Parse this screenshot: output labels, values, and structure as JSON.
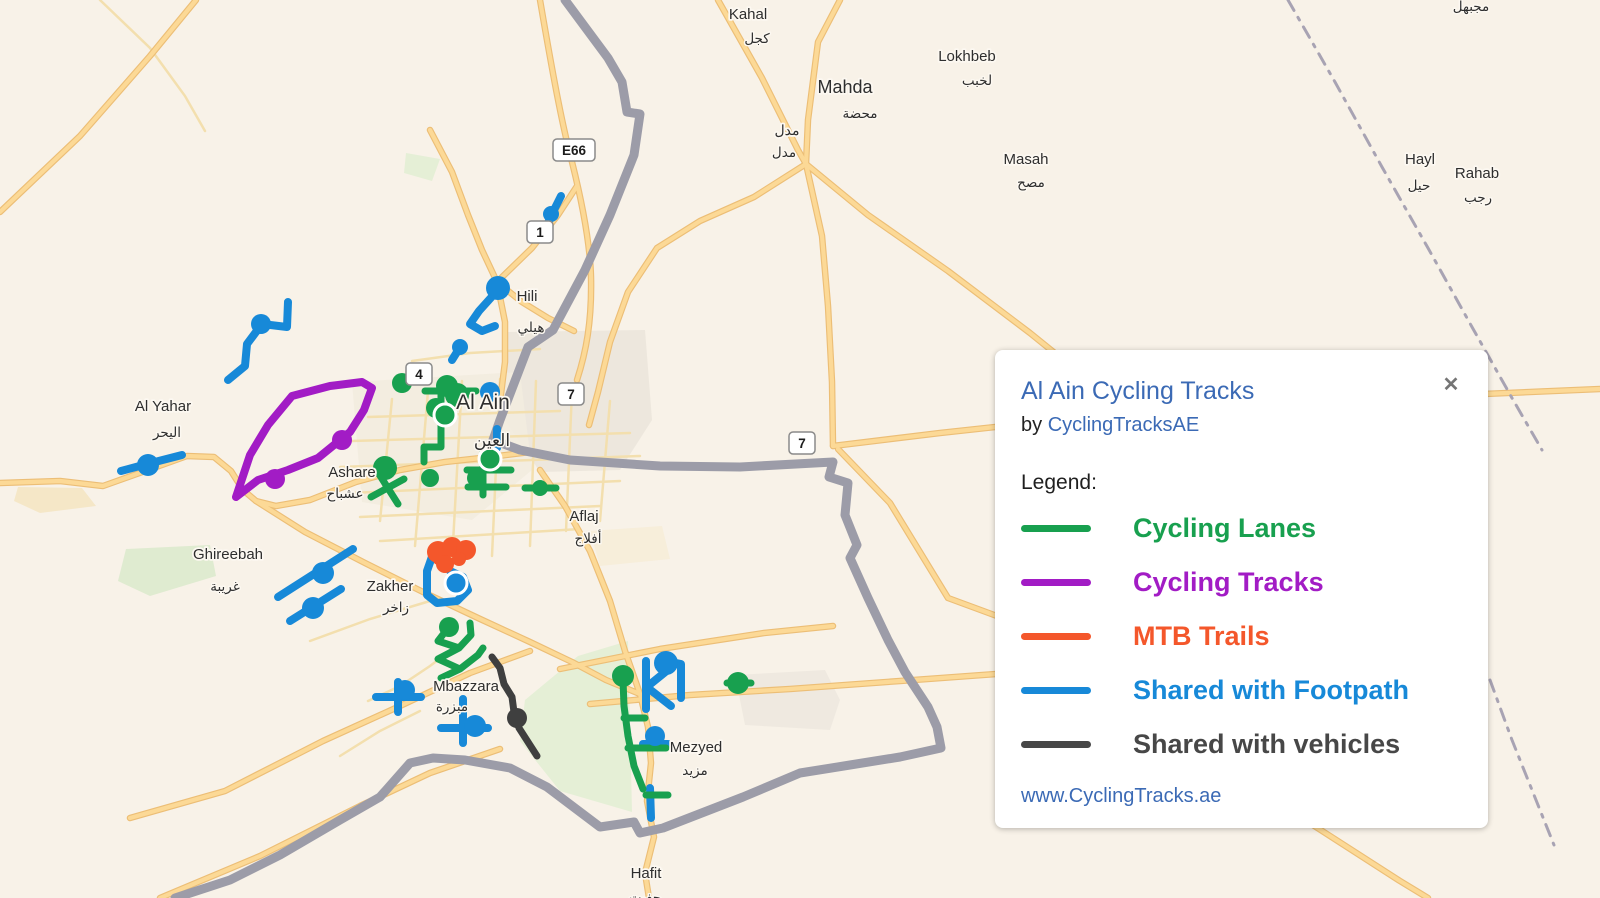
{
  "map": {
    "background": "#f8f2e8",
    "route_styles": {
      "lane": {
        "color": "#18a04f",
        "width": 7
      },
      "track": {
        "color": "#a21cc5",
        "width": 8
      },
      "mtb": {
        "color": "#f4572b",
        "width": 7
      },
      "foot": {
        "color": "#1789d8",
        "width": 8
      },
      "veh": {
        "color": "#3f3f3f",
        "width": 7
      }
    },
    "boundary_color": "#9c9ca8",
    "admin_color": "#a8a3b3",
    "patches": [
      {
        "fill": "#ebe5db",
        "d": "M505,332 L645,330 652,420 620,470 540,472 505,420 Z"
      },
      {
        "fill": "#f2ecdf",
        "d": "M352,382 L520,372 532,470 472,520 362,502 Z"
      },
      {
        "fill": "#dceacd",
        "d": "M126,549 L210,545 216,576 150,596 118,581 Z"
      },
      {
        "fill": "#e2eed4",
        "d": "M525,700 L578,656 628,641 632,812 560,791 520,741 Z"
      },
      {
        "fill": "#ede8df",
        "d": "M735,675 L825,670 840,700 830,730 745,725 Z"
      },
      {
        "fill": "#f4e6c3",
        "d": "M18,487 L82,488 96,506 40,513 14,501 Z"
      },
      {
        "fill": "#e2eed4",
        "d": "M406,153 L440,159 432,181 404,173 Z"
      },
      {
        "fill": "#f6edd8",
        "d": "M590,531 L662,526 670,559 600,566 Z"
      }
    ],
    "roads_major": [
      {
        "d": "M540,0 C552,70 562,125 572,162 C582,202 590,242 591,277 C592,322 586,352 577,380"
      },
      {
        "d": "M718,0 L762,78 798,150 806,164"
      },
      {
        "d": "M840,0 L818,42 808,120 806,164"
      },
      {
        "d": "M806,164 L754,197 700,221 657,248 628,292 610,342 598,392 589,425"
      },
      {
        "d": "M806,164 L822,236 828,306 832,382 833,446"
      },
      {
        "d": "M806,164 L868,215 948,271 1030,333 1098,388"
      },
      {
        "d": "M0,483 L60,481 103,486 148,470 187,456 214,457 231,471 243,490 256,501 276,506 310,500 356,482 400,470 445,462 490,457 530,452"
      },
      {
        "d": "M256,501 L305,532 365,563 425,593 478,618 530,642 572,662 606,680 640,694"
      },
      {
        "d": "M640,694 L648,727 651,763 647,801 654,837 645,873 649,898"
      },
      {
        "d": "M833,446 L940,433 1050,421 1160,411 1300,403 1460,395 1600,389"
      },
      {
        "d": "M838,449 L890,503 948,598 1005,619 1065,641"
      },
      {
        "d": "M1005,619 L1120,701 1260,791 1400,881 1428,898"
      },
      {
        "d": "M590,704 L690,695 790,689 900,681 1010,673 1065,669"
      },
      {
        "d": "M560,669 L660,649 764,633 833,626"
      },
      {
        "d": "M430,130 L452,172 468,215 482,250 497,282 505,322 505,362 500,402"
      },
      {
        "d": "M497,282 L532,248 558,215 577,186"
      },
      {
        "d": "M130,818 L225,791 323,741 400,706 470,673 530,651"
      },
      {
        "d": "M160,898 L260,856 360,806 430,773 500,749"
      },
      {
        "d": "M0,212 L80,136 150,56 196,0"
      },
      {
        "d": "M540,470 L565,506 590,551 610,601 625,651 640,694"
      },
      {
        "d": "M497,282 L522,302 548,318 574,331"
      }
    ],
    "roads_minor": [
      {
        "d": "M368,417 L560,411"
      },
      {
        "d": "M352,441 L630,433"
      },
      {
        "d": "M340,467 L640,456"
      },
      {
        "d": "M350,493 L620,481"
      },
      {
        "d": "M360,517 L600,506"
      },
      {
        "d": "M380,541 L580,529"
      },
      {
        "d": "M392,399 L380,521"
      },
      {
        "d": "M428,391 L415,546"
      },
      {
        "d": "M462,381 L452,561"
      },
      {
        "d": "M500,379 L492,556"
      },
      {
        "d": "M536,381 L530,546"
      },
      {
        "d": "M572,391 L566,531"
      },
      {
        "d": "M610,401 L600,521"
      },
      {
        "d": "M412,361 L470,353 540,349"
      },
      {
        "d": "M310,641 L370,619 430,601"
      },
      {
        "d": "M420,711 L380,731 340,756"
      },
      {
        "d": "M463,641 L430,666 400,686 368,701"
      },
      {
        "d": "M100,0 L150,48 185,96 205,131"
      }
    ],
    "boundary": "M565,0 L608,58 622,82 627,112 640,114 634,155 610,215 585,270 553,330 528,347 500,420 493,440 520,450 570,460 660,466 740,467 833,462 829,477 848,483 845,515 857,545 850,558 868,598 888,640 905,672 928,707 937,727 941,748 900,757 850,765 800,773 743,797 663,828 640,833 634,822 600,827 547,787 510,768 465,760 433,758 410,763 380,797 340,820 280,855 230,880 175,898",
    "admin_dashes": [
      "M1288,0 L1335,82 1382,167 1428,248 1472,327 1512,398 1542,450",
      "M1490,680 L1512,740 1536,800 1554,845"
    ],
    "routes": [
      {
        "kind": "track",
        "d": "M236,497 L250,455 268,425 292,396 330,386 362,382 372,388 364,410 350,432 318,458 288,470 258,480 236,497"
      },
      {
        "kind": "foot",
        "d": "M288,302 L287,327 262,324 247,344 245,366 228,380"
      },
      {
        "kind": "foot",
        "d": "M561,196 L552,214 544,232"
      },
      {
        "kind": "foot",
        "d": "M497,291 L479,311 470,324 482,331 495,326"
      },
      {
        "kind": "foot",
        "d": "M462,344 L452,360"
      },
      {
        "kind": "foot",
        "d": "M121,471 L147,464 182,455"
      },
      {
        "kind": "foot",
        "d": "M278,597 L353,549"
      },
      {
        "kind": "foot",
        "d": "M290,621 L341,589"
      },
      {
        "kind": "foot",
        "d": "M434,551 L427,571 427,595 437,603 457,601 468,590 463,577 450,571"
      },
      {
        "kind": "foot",
        "d": "M376,697 L421,697 M398,682 L398,712"
      },
      {
        "kind": "foot",
        "d": "M463,699 L463,743 M441,728 L488,728"
      },
      {
        "kind": "foot",
        "d": "M646,661 L646,709 M648,686 L669,669 M648,688 L671,706 M666,661 L681,664 681,698"
      },
      {
        "kind": "foot",
        "d": "M643,744 L668,744"
      },
      {
        "kind": "foot",
        "d": "M650,788 L651,818"
      },
      {
        "kind": "foot",
        "d": "M497,429 L497,448"
      },
      {
        "kind": "veh",
        "d": "M492,657 L500,668 504,684 512,697 514,712 519,728 528,742 537,756"
      },
      {
        "kind": "lane",
        "d": "M425,391 L476,391"
      },
      {
        "kind": "lane",
        "d": "M441,391 L441,447 424,447 424,462"
      },
      {
        "kind": "lane",
        "d": "M467,470 L511,470 M483,450 L483,495 M468,487 L506,487"
      },
      {
        "kind": "lane",
        "d": "M525,488 L556,488"
      },
      {
        "kind": "lane",
        "d": "M371,497 L404,479 M379,474 L398,504"
      },
      {
        "kind": "lane",
        "d": "M407,380 L423,367"
      },
      {
        "kind": "lane",
        "d": "M448,628 L438,641 459,648 438,659 460,669 441,678 M459,648 L471,635 470,623 M460,669 L478,655 483,648"
      },
      {
        "kind": "lane",
        "d": "M623,680 L624,706 628,736 634,766 643,789 M624,718 L645,718 M628,748 L666,748 M646,795 L668,795"
      },
      {
        "kind": "lane",
        "d": "M727,683 L751,683"
      },
      {
        "kind": "mtb",
        "d": "M432,556 L445,548 458,546 468,551 M437,561 L448,563 459,559"
      }
    ],
    "markers": [
      {
        "c": "lane",
        "x": 402,
        "y": 383,
        "r": 10
      },
      {
        "c": "lane",
        "x": 447,
        "y": 386,
        "r": 11
      },
      {
        "c": "lane",
        "x": 457,
        "y": 395,
        "r": 12
      },
      {
        "c": "lane",
        "x": 436,
        "y": 408,
        "r": 10
      },
      {
        "c": "lane",
        "x": 445,
        "y": 415,
        "r": 11,
        "ring": true
      },
      {
        "c": "lane",
        "x": 490,
        "y": 459,
        "r": 11,
        "ring": true
      },
      {
        "c": "lane",
        "x": 430,
        "y": 478,
        "r": 9
      },
      {
        "c": "lane",
        "x": 476,
        "y": 478,
        "r": 9
      },
      {
        "c": "lane",
        "x": 385,
        "y": 468,
        "r": 12
      },
      {
        "c": "lane",
        "x": 540,
        "y": 488,
        "r": 8
      },
      {
        "c": "lane",
        "x": 449,
        "y": 627,
        "r": 10
      },
      {
        "c": "lane",
        "x": 623,
        "y": 676,
        "r": 11
      },
      {
        "c": "lane",
        "x": 738,
        "y": 683,
        "r": 11
      },
      {
        "c": "foot",
        "x": 261,
        "y": 324,
        "r": 10
      },
      {
        "c": "foot",
        "x": 148,
        "y": 465,
        "r": 11
      },
      {
        "c": "foot",
        "x": 498,
        "y": 288,
        "r": 12
      },
      {
        "c": "foot",
        "x": 460,
        "y": 347,
        "r": 8
      },
      {
        "c": "foot",
        "x": 551,
        "y": 214,
        "r": 8
      },
      {
        "c": "foot",
        "x": 543,
        "y": 231,
        "r": 8
      },
      {
        "c": "foot",
        "x": 490,
        "y": 392,
        "r": 10
      },
      {
        "c": "foot",
        "x": 323,
        "y": 573,
        "r": 11
      },
      {
        "c": "foot",
        "x": 313,
        "y": 608,
        "r": 11
      },
      {
        "c": "foot",
        "x": 456,
        "y": 583,
        "r": 11,
        "ring": true
      },
      {
        "c": "foot",
        "x": 405,
        "y": 690,
        "r": 10
      },
      {
        "c": "foot",
        "x": 475,
        "y": 726,
        "r": 11
      },
      {
        "c": "foot",
        "x": 666,
        "y": 663,
        "r": 12
      },
      {
        "c": "foot",
        "x": 655,
        "y": 736,
        "r": 10
      },
      {
        "c": "mtb",
        "x": 438,
        "y": 552,
        "r": 11
      },
      {
        "c": "mtb",
        "x": 452,
        "y": 547,
        "r": 10
      },
      {
        "c": "mtb",
        "x": 466,
        "y": 550,
        "r": 10
      },
      {
        "c": "mtb",
        "x": 445,
        "y": 564,
        "r": 9
      },
      {
        "c": "mtb",
        "x": 459,
        "y": 559,
        "r": 7
      },
      {
        "c": "veh",
        "x": 517,
        "y": 718,
        "r": 10
      },
      {
        "c": "track",
        "x": 342,
        "y": 440,
        "r": 10
      },
      {
        "c": "track",
        "x": 275,
        "y": 479,
        "r": 10
      }
    ],
    "places": [
      {
        "en": "Kahal",
        "ar": "كجل",
        "x": 748,
        "y": 14,
        "ax": 757,
        "ay": 38
      },
      {
        "en": "Mahda",
        "ar": "محضة",
        "x": 845,
        "y": 88,
        "ax": 860,
        "ay": 113,
        "size": 18
      },
      {
        "en": "مدل",
        "ar": "مدل",
        "x": 787,
        "y": 130,
        "ax": 784,
        "ay": 152,
        "size": 14
      },
      {
        "en": "Lokhbeb",
        "ar": "لخبب",
        "x": 967,
        "y": 56,
        "ax": 977,
        "ay": 80
      },
      {
        "en": "Masah",
        "ar": "مصح",
        "x": 1026,
        "y": 159,
        "ax": 1031,
        "ay": 182
      },
      {
        "en": "Hayl",
        "ar": "حيل",
        "x": 1420,
        "y": 159,
        "ax": 1419,
        "ay": 185
      },
      {
        "en": "Rahab",
        "ar": "رجب",
        "x": 1477,
        "y": 173,
        "ax": 1478,
        "ay": 197
      },
      {
        "en": "",
        "ar": "مجبهل",
        "x": 1471,
        "y": 0,
        "ax": 1471,
        "ay": 6,
        "size": 14
      },
      {
        "en": "Hili",
        "ar": "هيلي",
        "x": 527,
        "y": 296,
        "ax": 531,
        "ay": 327
      },
      {
        "en": "Al Ain",
        "ar": "العين",
        "x": 483,
        "y": 404,
        "ax": 492,
        "ay": 441,
        "size": 21,
        "arsize": 17
      },
      {
        "en": "Al Yahar",
        "ar": "اليحر",
        "x": 163,
        "y": 406,
        "ax": 167,
        "ay": 432
      },
      {
        "en": "Ashare",
        "ar": "عشباح",
        "x": 352,
        "y": 472,
        "ax": 345,
        "ay": 493
      },
      {
        "en": "Ghireebah",
        "ar": "غريبة",
        "x": 228,
        "y": 554,
        "ax": 225,
        "ay": 586
      },
      {
        "en": "Zakher",
        "ar": "زاخر",
        "x": 390,
        "y": 586,
        "ax": 396,
        "ay": 607
      },
      {
        "en": "Aflaj",
        "ar": "أفلاج",
        "x": 584,
        "y": 516,
        "ax": 588,
        "ay": 538
      },
      {
        "en": "Mbazzara",
        "ar": "مبزرة",
        "x": 466,
        "y": 686,
        "ax": 452,
        "ay": 706
      },
      {
        "en": "Mezyed",
        "ar": "مزيد",
        "x": 696,
        "y": 747,
        "ax": 695,
        "ay": 770
      },
      {
        "en": "Hafit",
        "ar": "حفيت",
        "x": 646,
        "y": 873,
        "ax": 645,
        "ay": 897
      }
    ],
    "shields": [
      {
        "t": "E66",
        "x": 574,
        "y": 150,
        "w": 42
      },
      {
        "t": "1",
        "x": 540,
        "y": 232,
        "w": 26
      },
      {
        "t": "4",
        "x": 419,
        "y": 374,
        "w": 26
      },
      {
        "t": "7",
        "x": 571,
        "y": 394,
        "w": 26
      },
      {
        "t": "7",
        "x": 802,
        "y": 443,
        "w": 26
      }
    ]
  },
  "legend_card": {
    "title": "Al Ain Cycling Tracks",
    "byline_prefix": "by",
    "author": "CyclingTracksAE",
    "legend_label": "Legend:",
    "items": [
      {
        "label": "Cycling Lanes",
        "color": "#18a04f"
      },
      {
        "label": "Cycling Tracks",
        "color": "#a21cc5"
      },
      {
        "label": "MTB Trails",
        "color": "#f4572b"
      },
      {
        "label": "Shared with Footpath",
        "color": "#1789d8"
      },
      {
        "label": "Shared with vehicles",
        "color": "#474747"
      }
    ],
    "website": "www.CyclingTracks.ae",
    "close_icon": "✕"
  }
}
